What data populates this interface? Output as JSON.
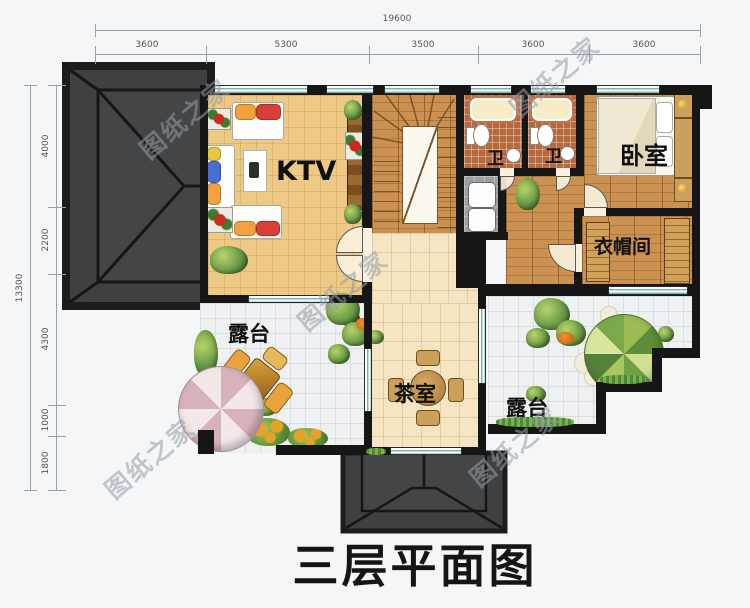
{
  "title": "三层平面图",
  "watermark": "图纸之家",
  "dims": {
    "top": {
      "total": "19600",
      "segments": [
        "3600",
        "5300",
        "3500",
        "3600",
        "3600"
      ]
    },
    "left": {
      "total": "13300",
      "segments": [
        "4000",
        "2200",
        "4300",
        "1000",
        "1800"
      ]
    }
  },
  "rooms": {
    "ktv": {
      "label": "KTV"
    },
    "bath1": {
      "label": "卫"
    },
    "bath2": {
      "label": "卫"
    },
    "bedroom": {
      "label": "卧室"
    },
    "cloakroom": {
      "label": "衣帽间"
    },
    "tearoom": {
      "label": "茶室"
    },
    "terrace_left": {
      "label": "露台"
    },
    "terrace_right": {
      "label": "露台"
    }
  },
  "colors": {
    "wall": "#161616",
    "roof": "#3e4042",
    "window": "#7ab7af",
    "wood_floor": "#cb9150",
    "ktv_tile": "#edc985",
    "warm_tile": "#f5e5c2",
    "terrace_tile": "#eef0f2",
    "bath_tile": "#b5693f",
    "background": "#f5f6f8"
  }
}
